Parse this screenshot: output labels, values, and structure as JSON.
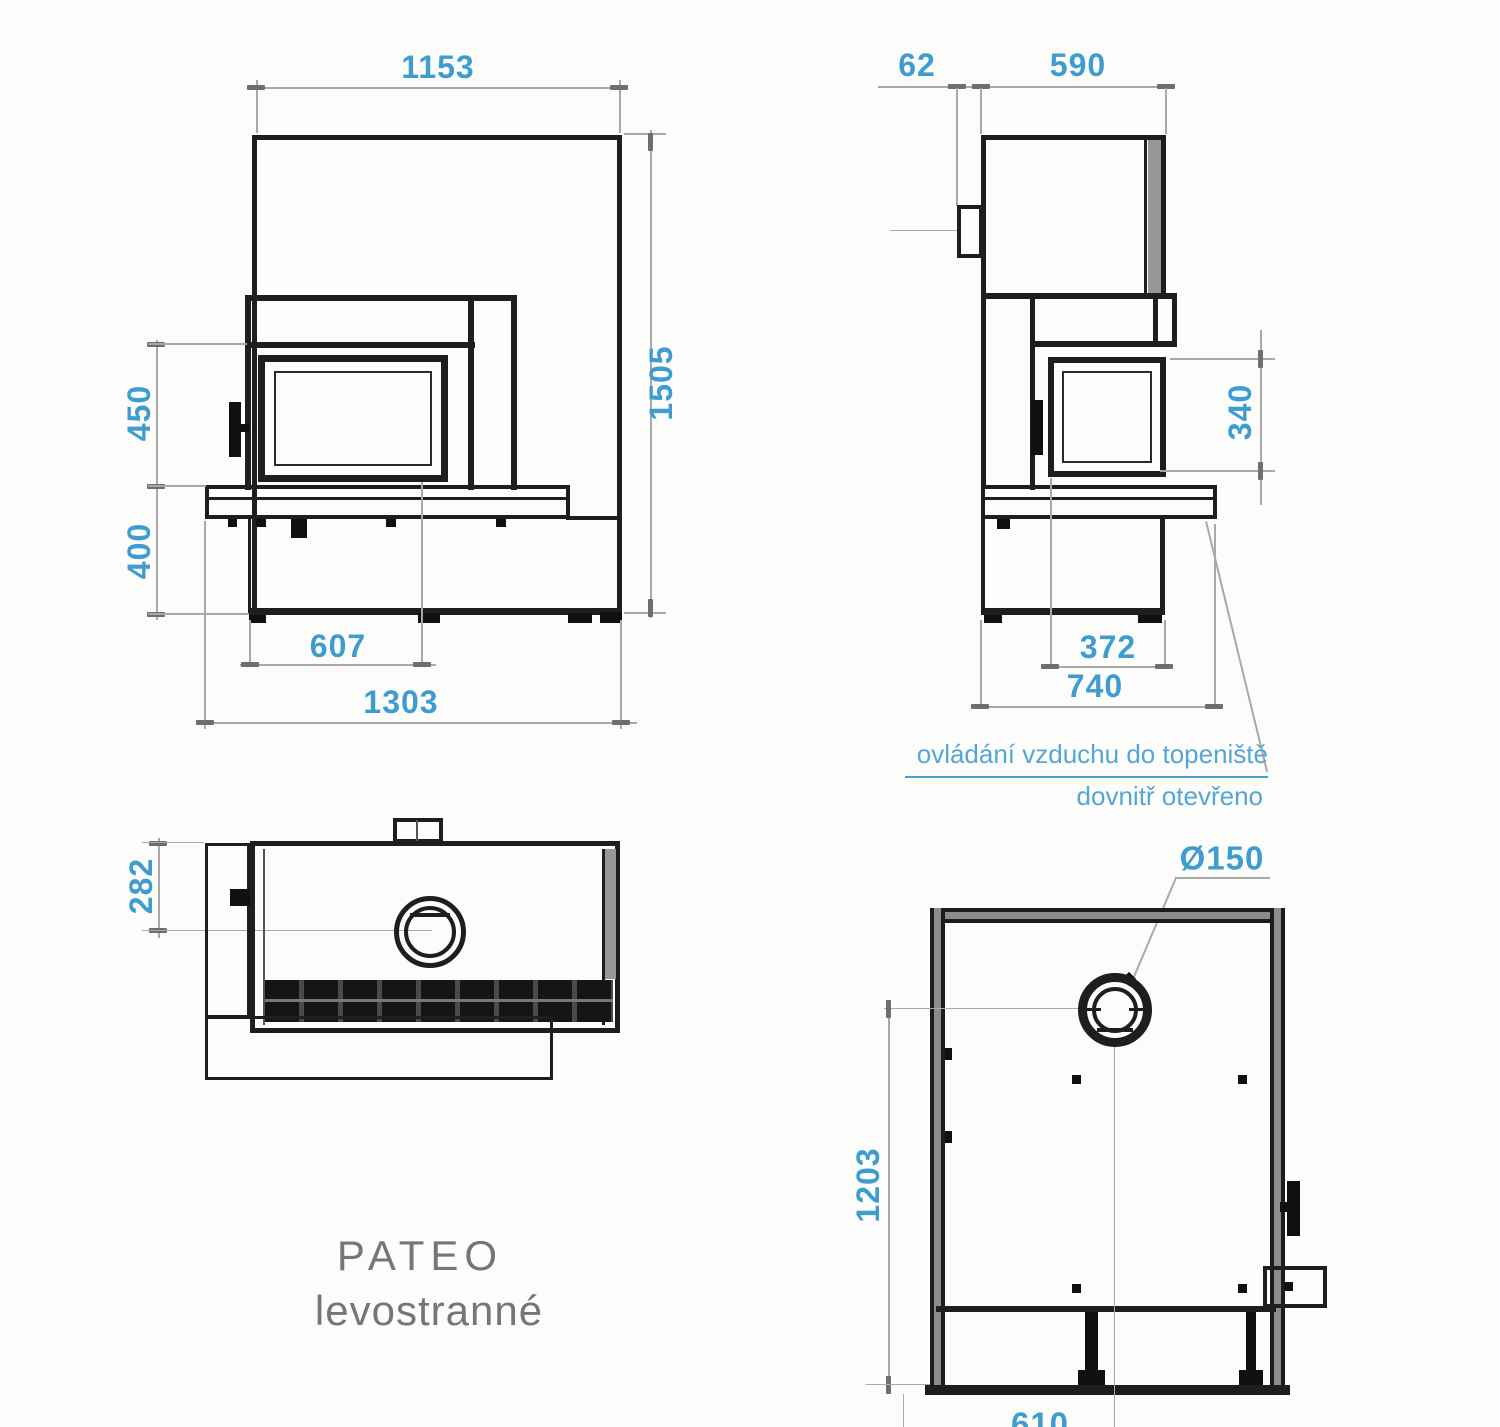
{
  "title": {
    "line1": "PATEO",
    "line2": "levostranné"
  },
  "annotation": {
    "line1": "ovládání vzduchu do topeniště",
    "line2": "dovnitř otevřeno"
  },
  "front_view": {
    "width_top": "1153",
    "total_height": "1505",
    "opening_height": "450",
    "plinth_height": "400",
    "opening_width": "607",
    "total_width": "1303"
  },
  "side_view": {
    "connector_depth": "62",
    "body_depth": "590",
    "side_window_height": "340",
    "side_window_width": "372",
    "total_depth": "740"
  },
  "top_view": {
    "flue_center_offset": "282"
  },
  "plan_view": {
    "flue_diameter": "Ø150",
    "depth_to_flue_center": "1203",
    "width_to_flue_center": "610"
  },
  "colors": {
    "dimension_text": "#3F9CCE",
    "annotation_text": "#54A7D4",
    "outline": "#1E1E1E",
    "dimension_line": "#A9A9A9",
    "title_text": "#767676",
    "wall_shade": "#969696",
    "background": "#FCFCFA"
  }
}
